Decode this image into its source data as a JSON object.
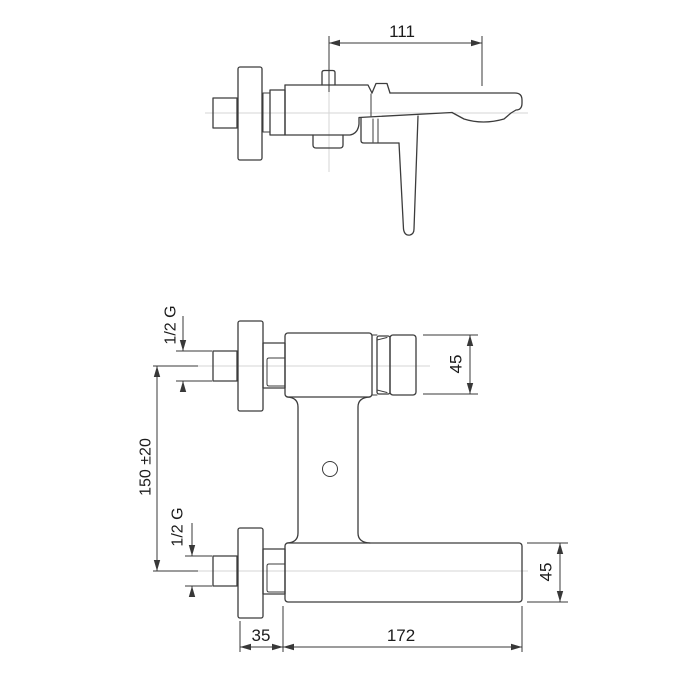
{
  "colors": {
    "background": "#ffffff",
    "line": "#3c3c3c",
    "dim_line": "#383838",
    "centerline": "#d6d6d6",
    "text": "#1c1c1c"
  },
  "dimensions": {
    "spout_reach": "111",
    "top_inlet_thread": "1/2 G",
    "inlet_spacing": "150 ±20",
    "bottom_inlet_thread": "1/2 G",
    "valve_body_height": "45",
    "spout_body_height": "45",
    "wall_clearance": "35",
    "body_length": "172"
  }
}
